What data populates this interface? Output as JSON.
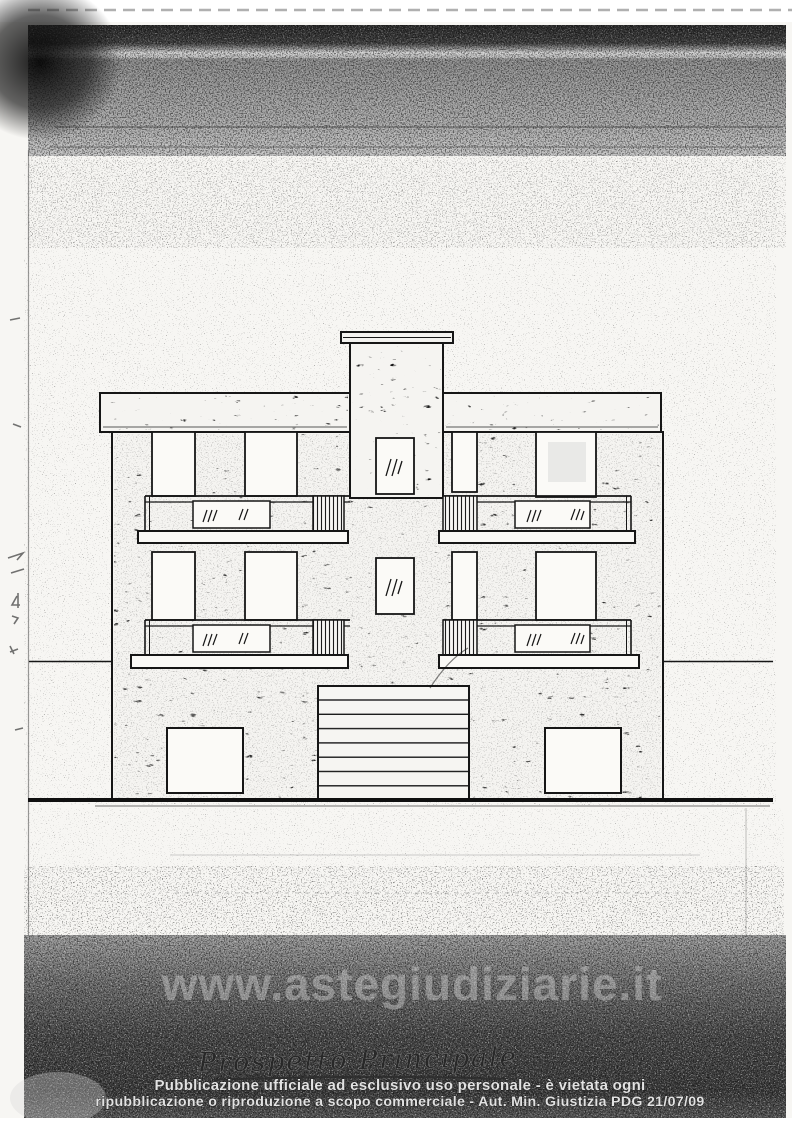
{
  "watermark": {
    "text": "www.astegiudiziarie.it"
  },
  "caption": {
    "text": "Prospetto Principale"
  },
  "footer": {
    "line1": "Pubblicazione ufficiale ad esclusivo uso personale - è vietata ogni",
    "line2": "ripubblicazione o riproduzione a scopo commerciale - Aut. Min. Giustizia PDG 21/07/09"
  },
  "colors": {
    "ink": "#161616",
    "paper": "#f7f6f3",
    "scan_band_dark": "#3b3b3b",
    "footer_text": "#e2e2e2",
    "watermark_text": "#d4d4d4"
  }
}
